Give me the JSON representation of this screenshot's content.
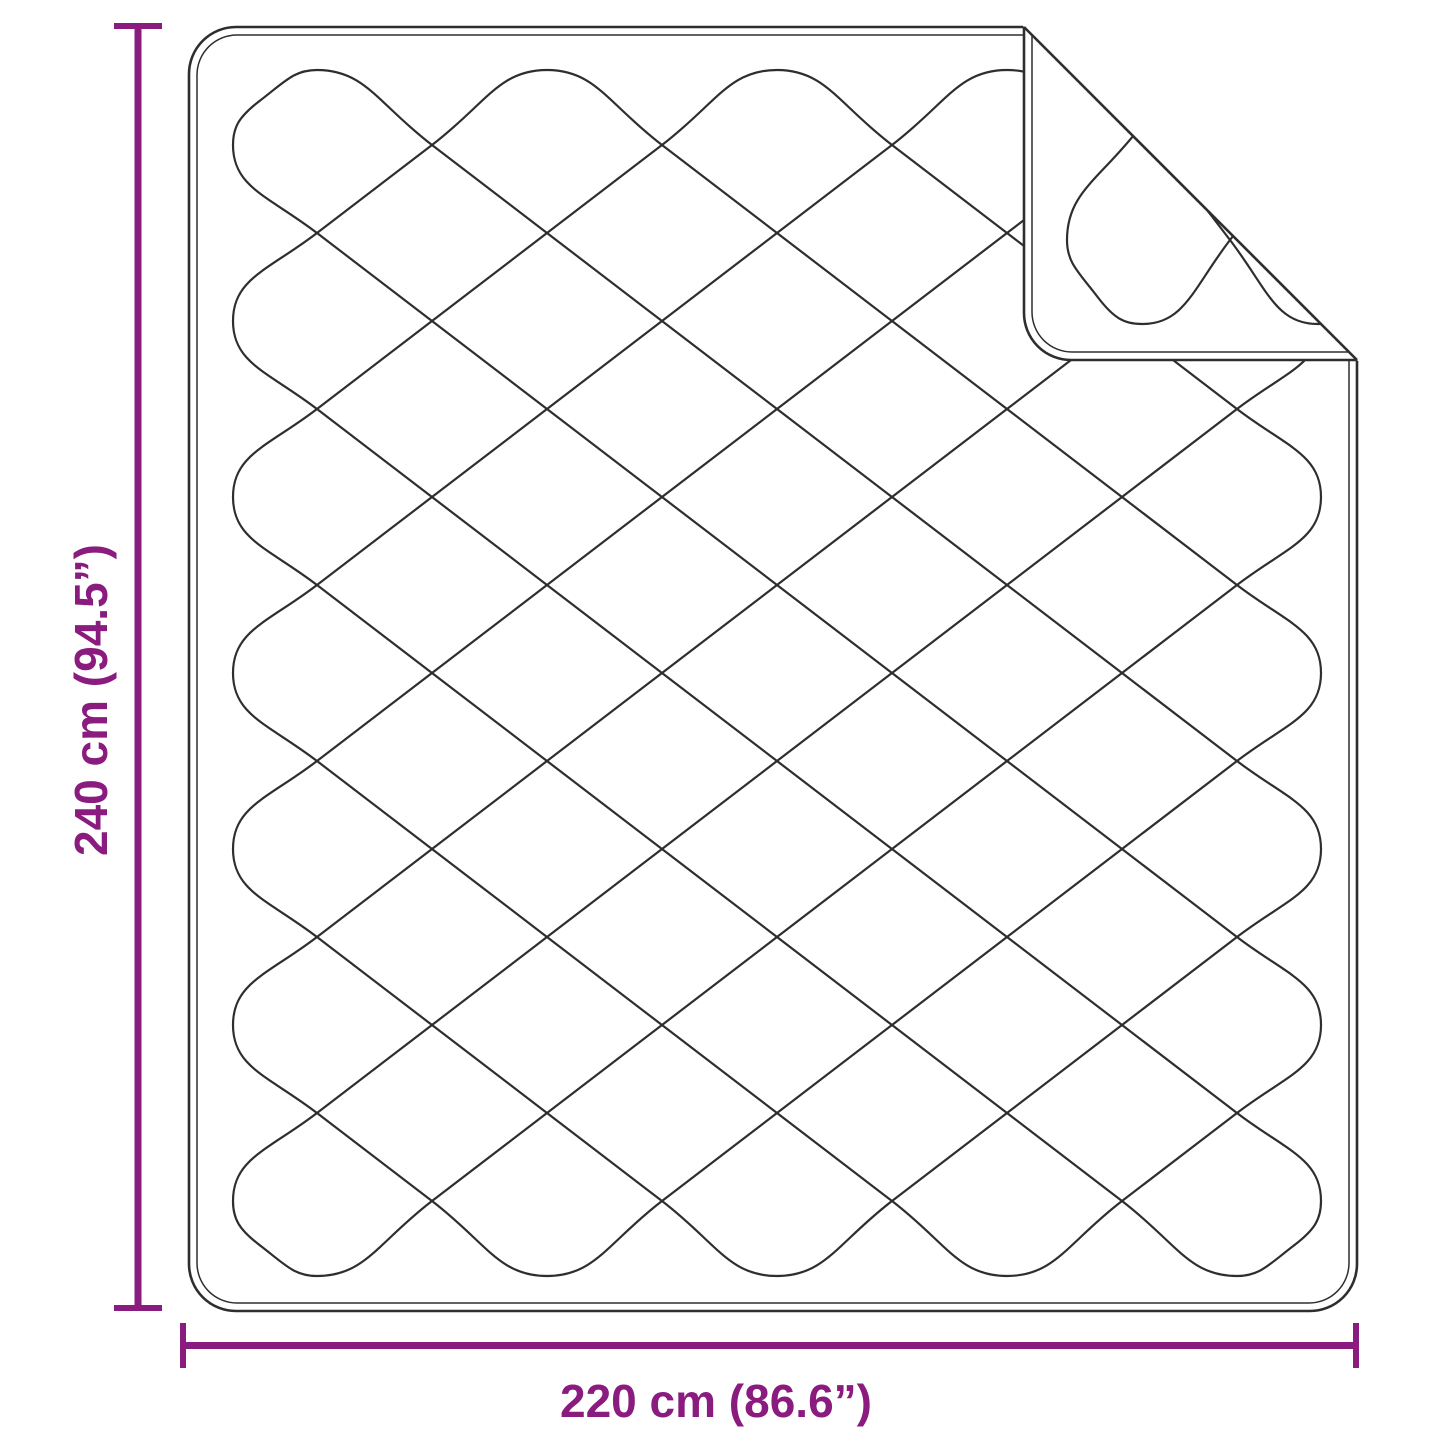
{
  "diagram": {
    "type": "product-dimension-diagram",
    "subject": "quilted blanket with folded top-right corner",
    "vertical_dimension": {
      "label": "240 cm (94.5”)",
      "value_cm": 240,
      "value_inches": 94.5
    },
    "horizontal_dimension": {
      "label": "220 cm (86.6”)",
      "value_cm": 220,
      "value_inches": 86.6
    },
    "colors": {
      "accent": "#8A1B7F",
      "line": "#2E2E2E",
      "background": "#FFFFFF"
    }
  }
}
